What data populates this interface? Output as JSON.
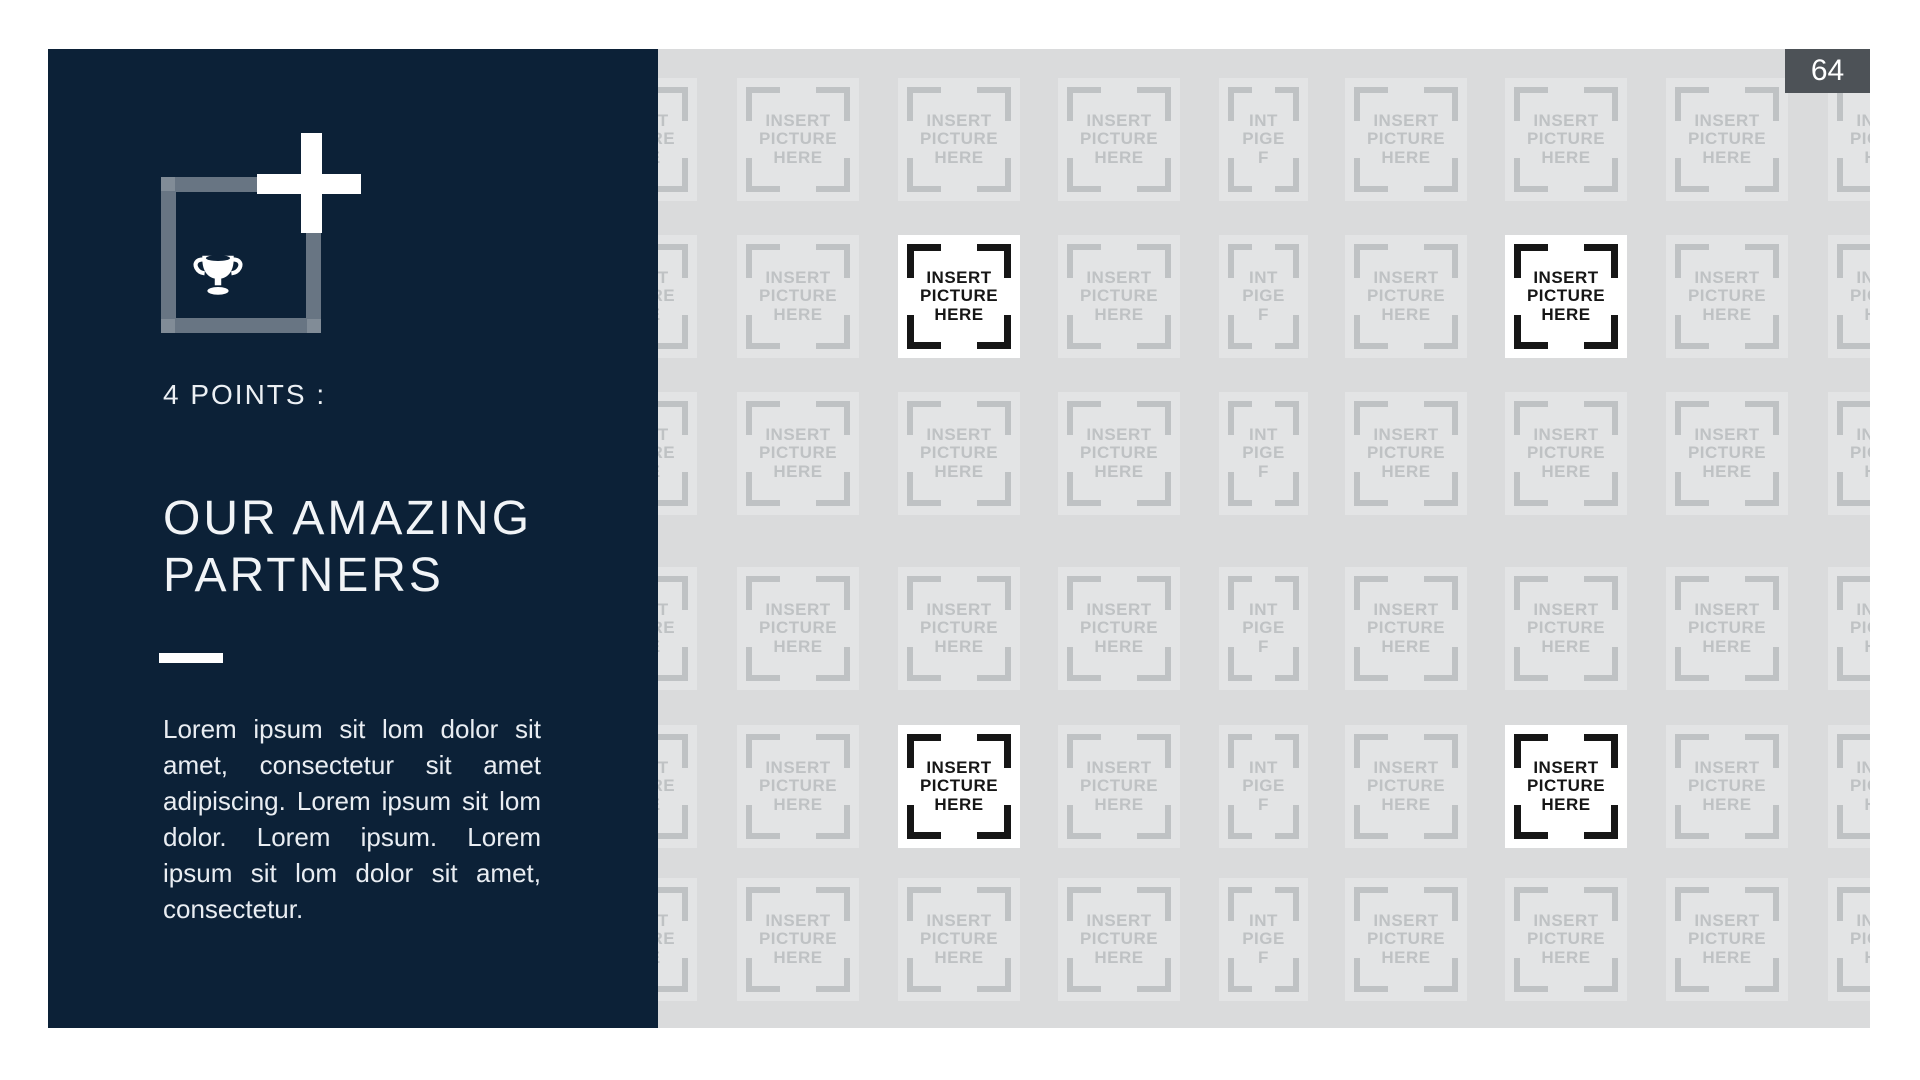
{
  "page_number": "64",
  "panel": {
    "kicker": "4 POINTS :",
    "title_lines": [
      "OUR AMAZING",
      "PARTNERS"
    ],
    "body": "Lorem ipsum sit lom dolor sit amet, consectetur sit amet adipiscing. Lorem ipsum sit lom dolor. Lorem ipsum. Lorem ipsum sit lom dolor sit amet, consectetur.",
    "icon": "trophy-icon"
  },
  "grid": {
    "rows": 6,
    "cols": 9,
    "placeholder_lines": [
      "INSERT",
      "PICTURE",
      "HERE"
    ],
    "narrow_placeholder_lines": [
      "INT",
      "PIGE",
      "F"
    ],
    "narrow_col": 4,
    "highlight_cells": [
      [
        1,
        2
      ],
      [
        1,
        6
      ],
      [
        4,
        2
      ],
      [
        4,
        6
      ]
    ]
  },
  "colors": {
    "panel_navy": "#0C2137",
    "slide_gray": "#DADBDC",
    "tile_gray": "#E3E4E5",
    "tile_fg": "#BFC2C4",
    "highlight_bg": "#FFFFFF",
    "highlight_fg": "#161616",
    "page_badge_bg": "#4D5257"
  }
}
